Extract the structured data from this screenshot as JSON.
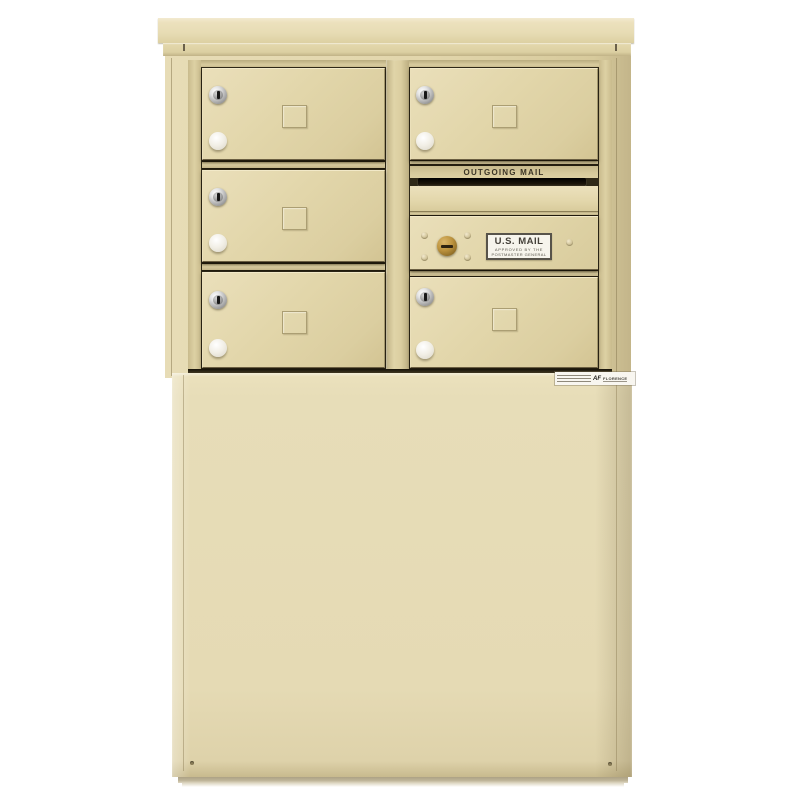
{
  "meta": {
    "description": "Free-standing 4C horizontal cluster mailbox unit in sandstone finish mounted on a matching depot pedestal, photographed on a white background",
    "background_color": "#ffffff"
  },
  "labels": {
    "outgoing_mail": "OUTGOING MAIL",
    "usps_decal_line1": "U.S. MAIL",
    "usps_decal_line2": "APPROVED BY THE",
    "usps_decal_line3": "POSTMASTER GENERAL",
    "manufacturer_logo": "AF",
    "manufacturer_name": "FLORENCE"
  },
  "components": {
    "tenant_doors_left_column": 3,
    "tenant_doors_right_column": 2,
    "outgoing_mail_slots": 1,
    "master_access_doors": 1,
    "tenant_door_hardware": [
      "silver-cam-lock",
      "white-round-knob",
      "card-holder-window"
    ],
    "master_door_hardware": [
      "brass-arrow-lock",
      "usps-approval-decal",
      "rivet-dimples"
    ]
  },
  "colors": {
    "sandstone_body": "#e5dab4",
    "sandstone_highlight": "#ece2bf",
    "sandstone_shade": "#cfc194",
    "recess_shadow": "#2f2918",
    "mail_slot_black": "#140f07",
    "tenant_lock_silver": "#c9c9c9",
    "master_lock_brass": "#bb923d",
    "knob_white": "#f1eee5",
    "decal_background": "#f6f4ec",
    "decal_border": "#57534a",
    "ground_shadow": "#aca184"
  }
}
